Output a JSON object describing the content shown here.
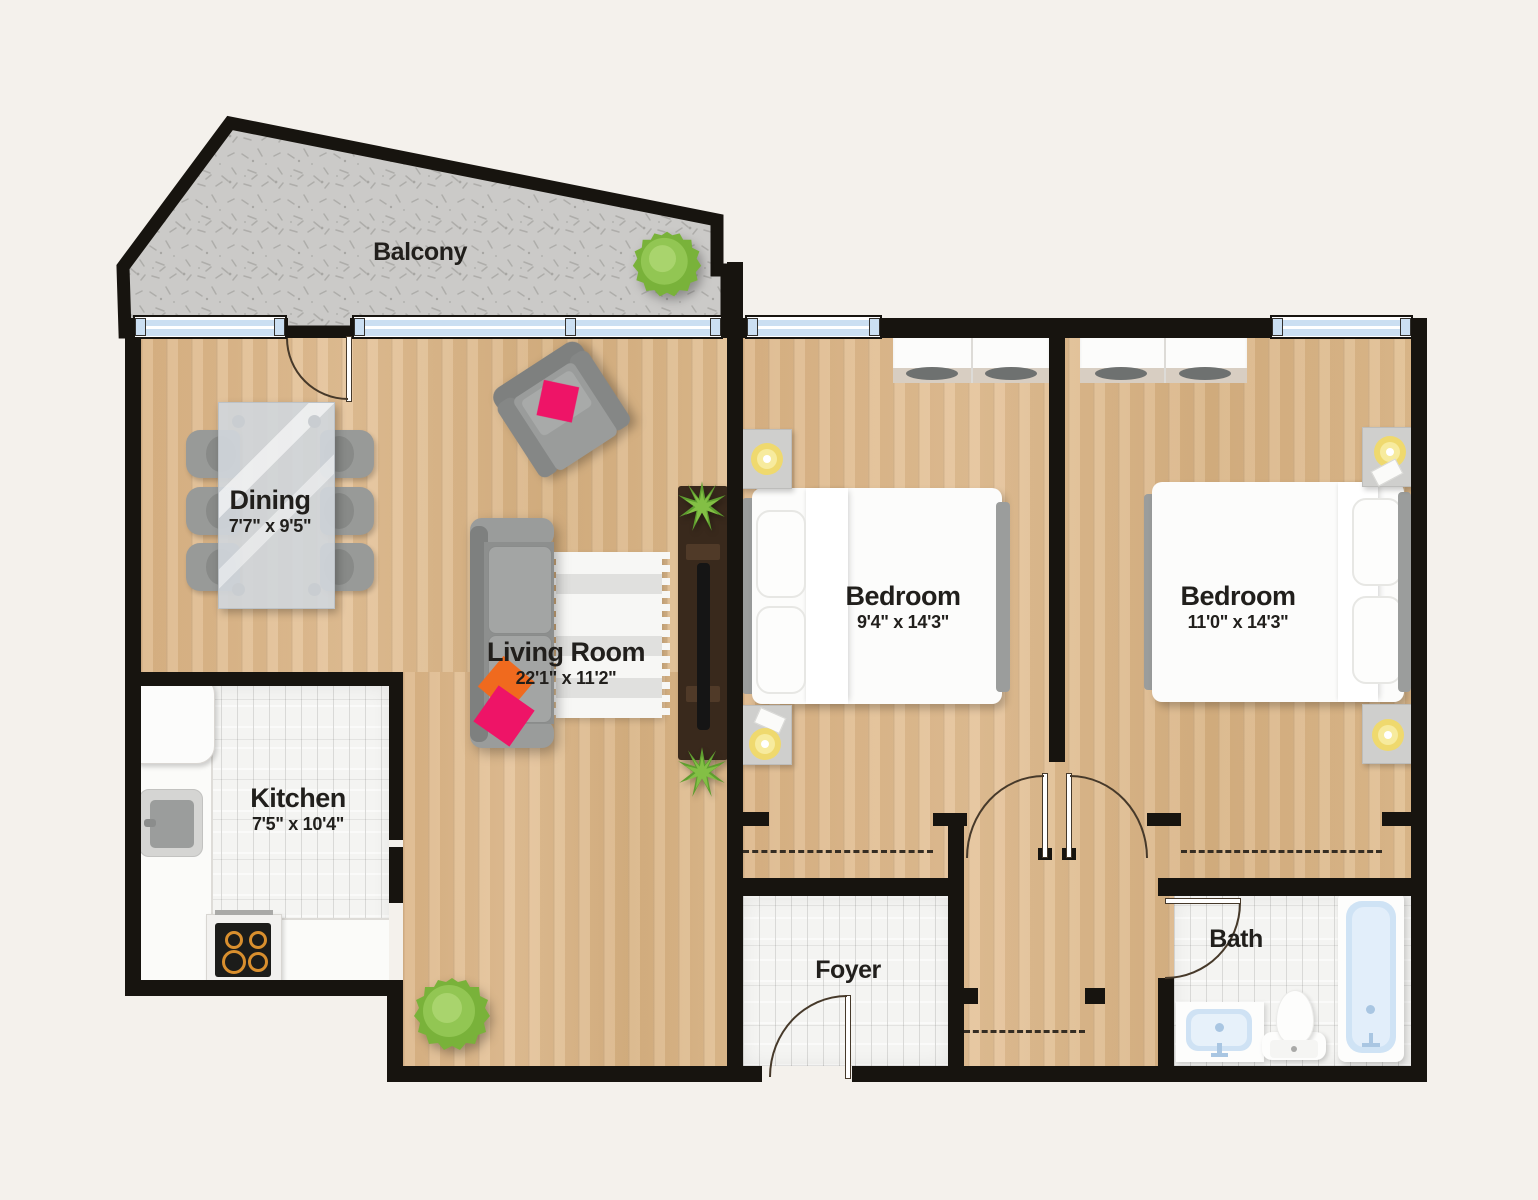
{
  "plan": {
    "rooms": [
      {
        "id": "balcony",
        "label": "Balcony",
        "dims": ""
      },
      {
        "id": "dining",
        "label": "Dining",
        "dims": "7'7\" x 9'5\""
      },
      {
        "id": "living-room",
        "label": "Living Room",
        "dims": "22'1\" x 11'2\""
      },
      {
        "id": "kitchen",
        "label": "Kitchen",
        "dims": "7'5\" x 10'4\""
      },
      {
        "id": "bedroom-1",
        "label": "Bedroom",
        "dims": "9'4\" x 14'3\""
      },
      {
        "id": "bedroom-2",
        "label": "Bedroom",
        "dims": "11'0\" x 14'3\""
      },
      {
        "id": "foyer",
        "label": "Foyer",
        "dims": ""
      },
      {
        "id": "bath",
        "label": "Bath",
        "dims": ""
      }
    ],
    "colors": {
      "background": "#f4f1ec",
      "wall": "#17140f",
      "wood_floor": "#deba8e",
      "tile_floor": "#f3f3f1",
      "balcony_concrete": "#cbcac8",
      "window_glass": "#cbdff2",
      "label_text": "#211f1c",
      "furniture_gray": "#8d8f8e",
      "pink_pillow": "#ee1467",
      "orange_pillow": "#f06a1e",
      "plant_green": "#8cc63e",
      "lamp_yellow": "#efd96e",
      "bath_fixture_blue": "#d3e5f6"
    }
  }
}
